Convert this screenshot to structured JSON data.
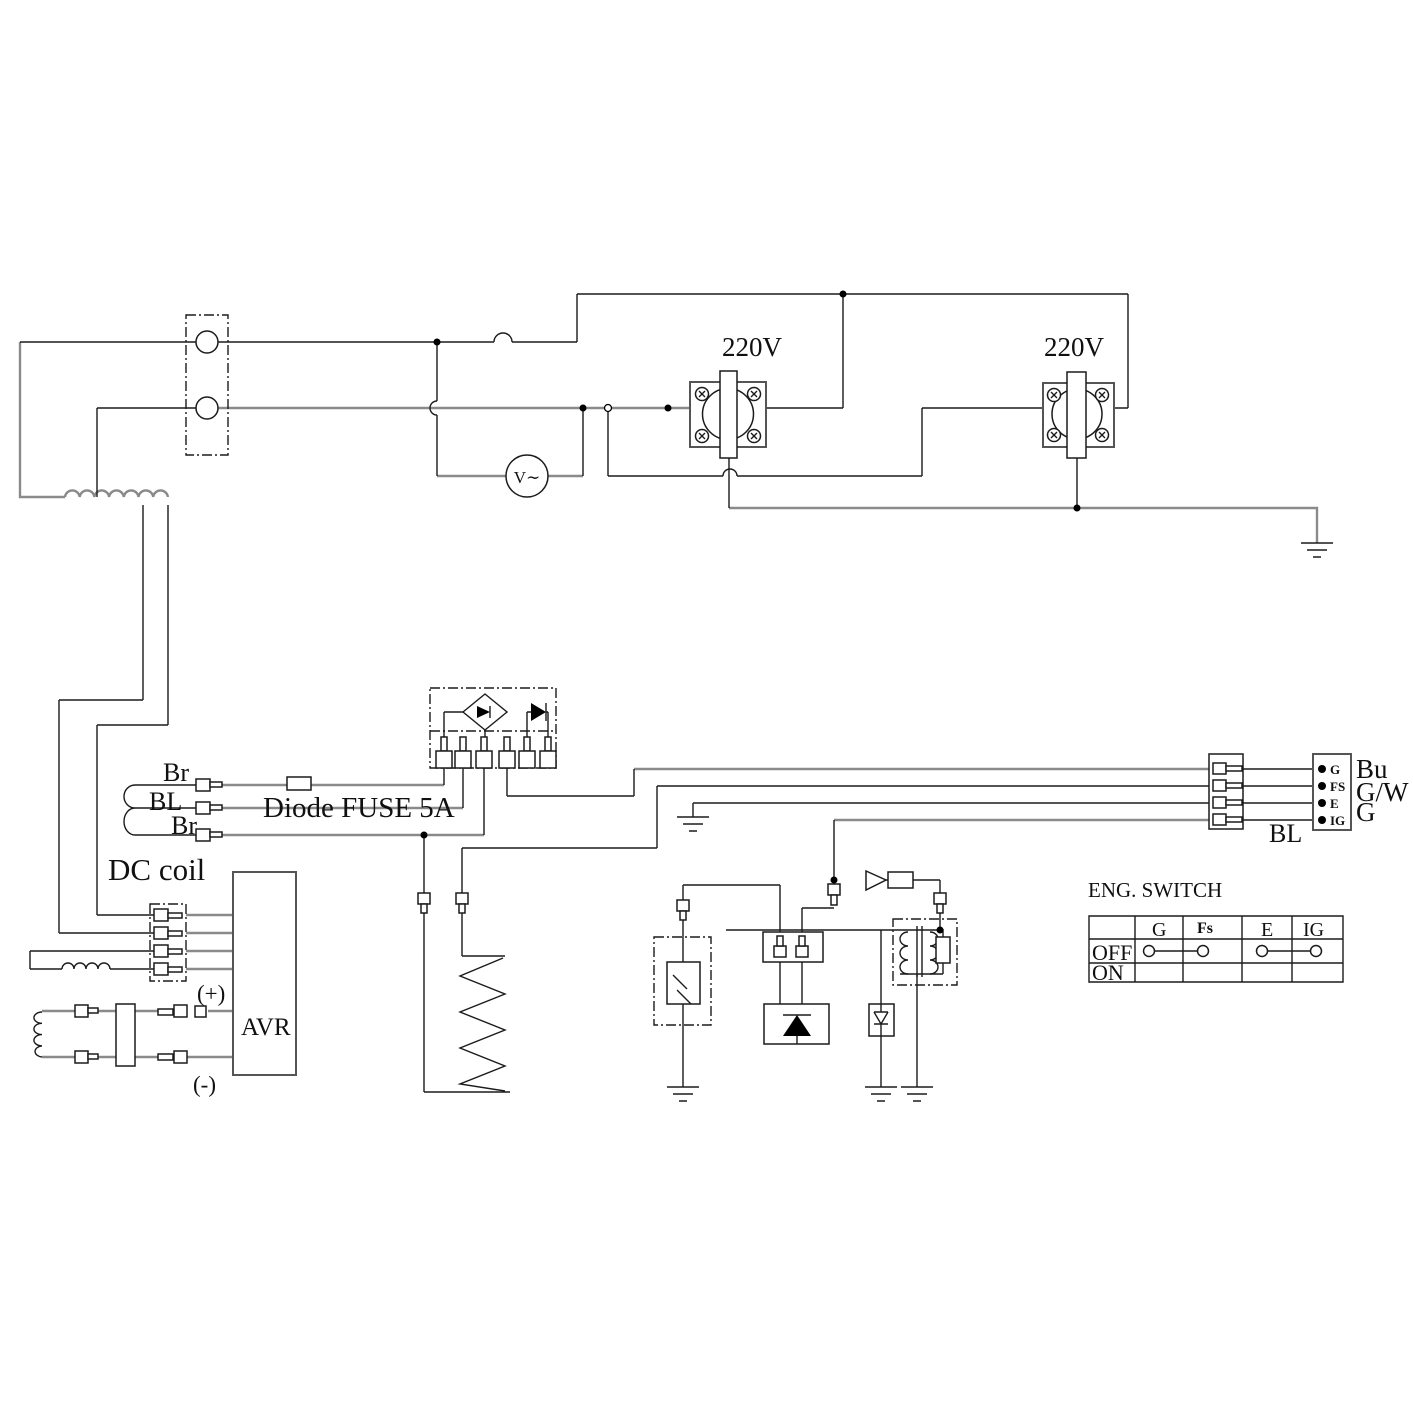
{
  "outlets": {
    "left_label": "220V",
    "right_label": "220V"
  },
  "voltmeter": {
    "label": "V∼"
  },
  "generator": {
    "wire1": "Br",
    "wire2": "BL",
    "wire3": "Br",
    "fuse_label": "Diode FUSE 5A",
    "coil_label": "DC coil"
  },
  "avr": {
    "label": "AVR",
    "plus": "(+)",
    "minus": "(-)"
  },
  "harness": {
    "left_color": "BL",
    "pins": [
      "G",
      "FS",
      "E",
      "IG"
    ],
    "right_colors": [
      "Bu",
      "G/W",
      "G"
    ]
  },
  "eng_switch": {
    "title": "ENG. SWITCH",
    "columns": [
      "G",
      "Fs",
      "E",
      "IG"
    ],
    "rows": [
      "OFF",
      "ON"
    ]
  }
}
